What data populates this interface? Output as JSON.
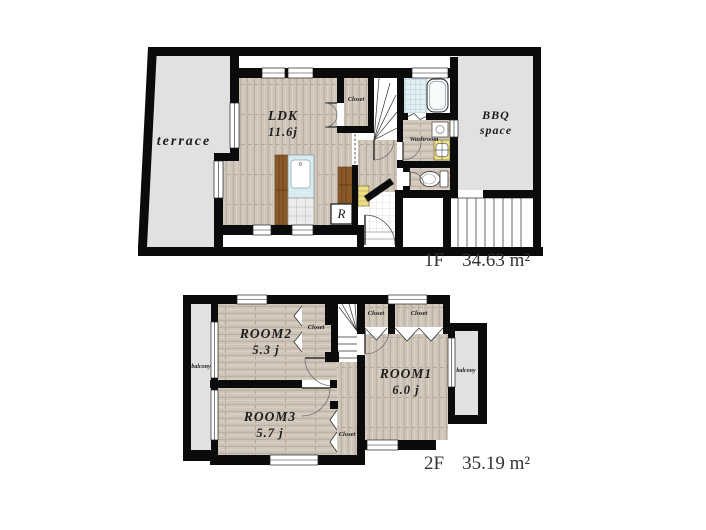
{
  "floor1": {
    "floor_label": "1F",
    "area_label": "34.63 m²",
    "terrace": "terrace",
    "ldk_name": "LDK",
    "ldk_size": "11.6j",
    "closet": "Closet",
    "washroom": "Washroom",
    "bbq_line1": "BBQ",
    "bbq_line2": "space",
    "refrigerator": "R"
  },
  "floor2": {
    "floor_label": "2F",
    "area_label": "35.19 m²",
    "room1_name": "ROOM1",
    "room1_size": "6.0 j",
    "room2_name": "ROOM2",
    "room2_size": "5.3 j",
    "room3_name": "ROOM3",
    "room3_size": "5.7 j",
    "closet_near_room2": "Closet",
    "closet_top_left": "Closet",
    "closet_top_right": "Closet",
    "closet_near_room3": "Closet",
    "balcony_left": "balcony",
    "balcony_right": "balcony"
  },
  "colors": {
    "wall": "#0b0b0b",
    "wood_floor": "#cfc5b8",
    "outdoor_gray": "#e1e1e1",
    "kitchen_brown": "#8a5a2b",
    "fixture_yellow": "#ecdf86",
    "bath_tile": "#e2f0f4"
  }
}
